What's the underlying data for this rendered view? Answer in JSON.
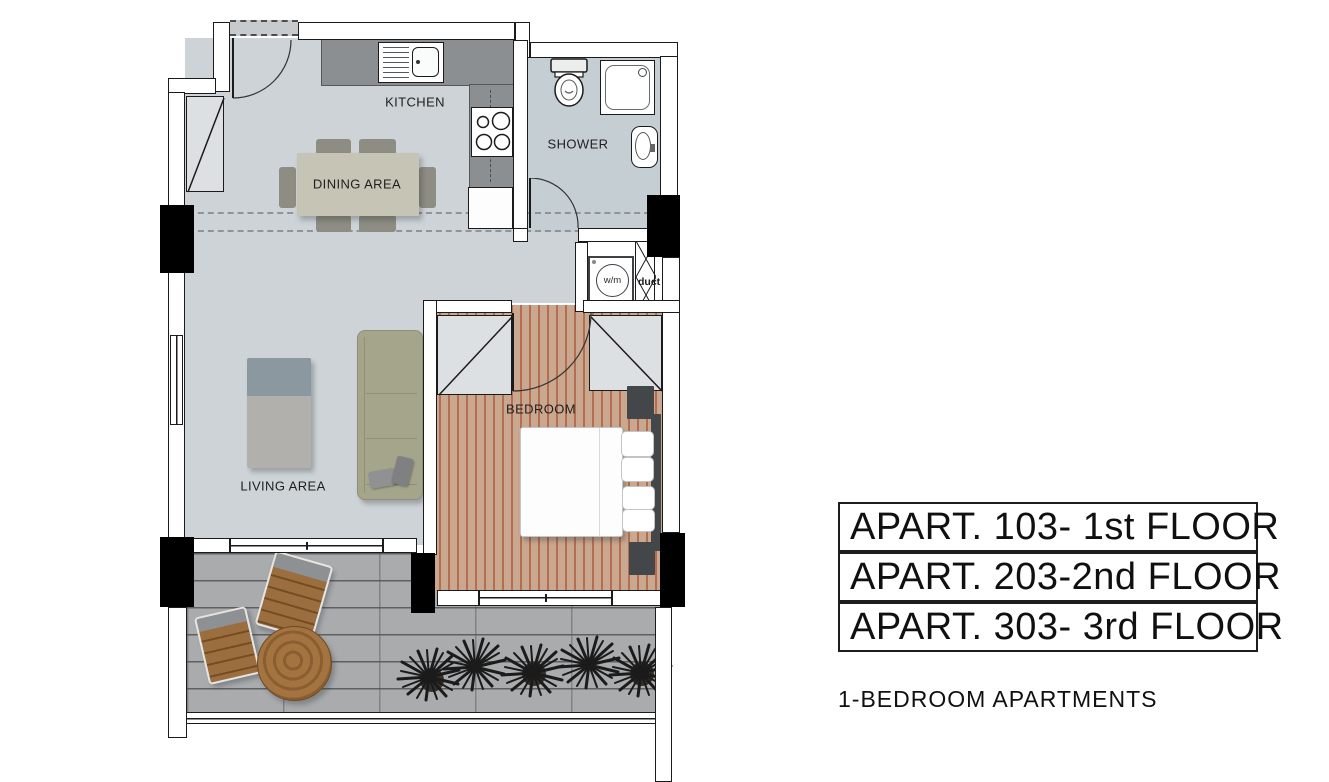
{
  "plan": {
    "rooms": {
      "kitchen": "KITCHEN",
      "shower": "SHOWER",
      "dining": "DINING AREA",
      "living": "LIVING AREA",
      "bedroom": "BEDROOM",
      "washing_machine": "w/m",
      "duct": "duct"
    }
  },
  "legend": {
    "apartments": [
      "APART. 103- 1st FLOOR",
      "APART. 203-2nd FLOOR",
      "APART. 303- 3rd FLOOR"
    ],
    "caption": "1-BEDROOM APARTMENTS"
  },
  "colors": {
    "floor_main": "#cdd3d7",
    "floor_shower": "#c4ced3",
    "floor_bedroom_wood": "#c9a88f",
    "bedroom_wood_stripe": "#b56d52",
    "terrace_paver": "#a9abad",
    "kitchen_counter": "#8b8f92",
    "sofa_sage": "#a5a58c",
    "dark_fixture": "#44474a",
    "wall_line": "#1b1b1b"
  }
}
